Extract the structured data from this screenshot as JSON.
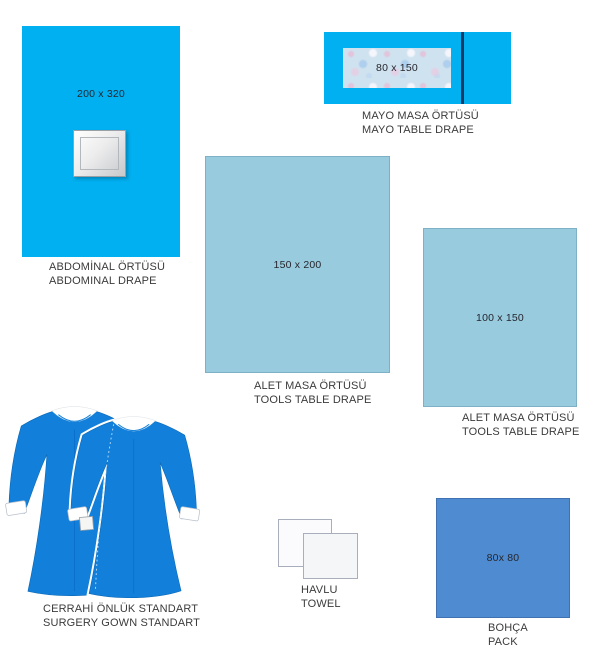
{
  "colors": {
    "drape_cyan": "#00b0f0",
    "table_drape_blue": "#98cbdd",
    "pack_blue": "#4e8bd0",
    "gown_blue": "#1280db",
    "mayo_fold_line_navy": "#1f3864",
    "fenestration_gray": "#d9dadb",
    "towel_white": "#fbfbfd",
    "caption_text": "#3b3b3b"
  },
  "items": {
    "abdominal": {
      "size": "200 x 320",
      "line1": "ABDOMİNAL ÖRTÜSÜ",
      "line2": "ABDOMINAL DRAPE"
    },
    "mayo": {
      "size": "80 x 150",
      "line1": "MAYO MASA ÖRTÜSÜ",
      "line2": "MAYO TABLE DRAPE"
    },
    "tools_large": {
      "size": "150 x 200",
      "line1": "ALET MASA ÖRTÜSÜ",
      "line2": "TOOLS TABLE DRAPE"
    },
    "tools_small": {
      "size": "100 x 150",
      "line1": "ALET MASA ÖRTÜSÜ",
      "line2": "TOOLS TABLE DRAPE"
    },
    "gowns": {
      "line1": "CERRAHİ ÖNLÜK STANDART",
      "line2": "SURGERY GOWN STANDART"
    },
    "towels": {
      "line1": "HAVLU",
      "line2": "TOWEL"
    },
    "pack": {
      "size": "80x 80",
      "line1": "BOHÇA",
      "line2": "PACK"
    }
  }
}
